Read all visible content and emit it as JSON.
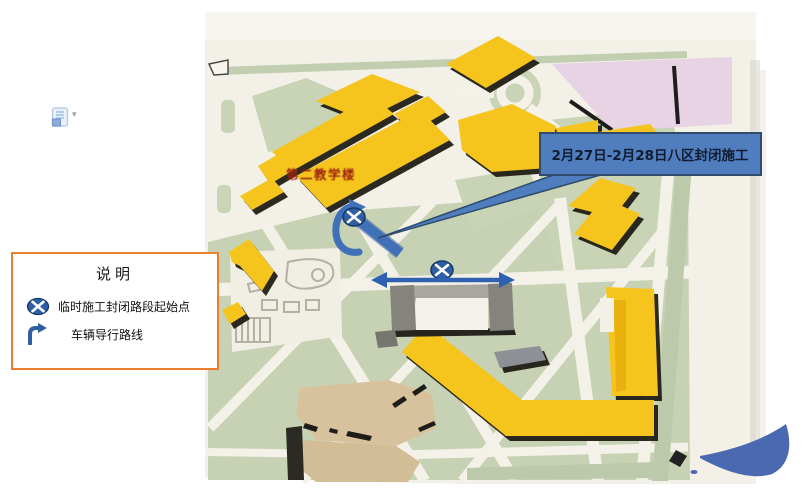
{
  "callout": {
    "label": "2月27日-2月28日八区封闭施工"
  },
  "legend": {
    "title": "说明",
    "items": [
      {
        "icon": "closure-point-icon",
        "label": "临时施工封闭路段起始点"
      },
      {
        "icon": "detour-route-icon",
        "label": "车辆导行路线"
      }
    ]
  },
  "map": {
    "labels": {
      "building": "第二教学楼"
    }
  },
  "icons": {
    "paste_options": "paste-options-icon",
    "dropdown_caret": "▾"
  },
  "colors": {
    "annotation_blue": "#4070B8",
    "marker_blue": "#2E5FA3",
    "callout_fill": "#4F7DBE",
    "callout_border": "#2F4B6E",
    "legend_border_orange": "#ED7D31",
    "building_yellow": "#F5C41D",
    "map_green": "#C7D2B4",
    "map_cream": "#F2F0E7",
    "field_pink": "#E7D3E3"
  }
}
